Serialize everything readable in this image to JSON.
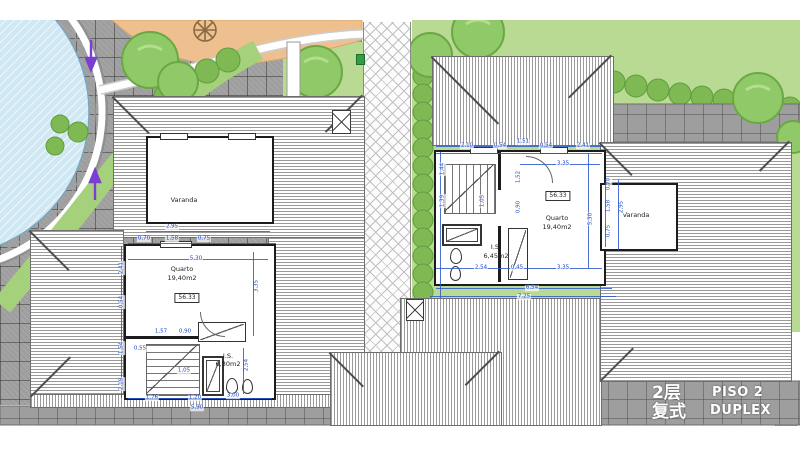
{
  "footer": {
    "floor_cn": "2层",
    "type_cn": "复式",
    "floor_pt": "PISO 2",
    "type_pt": "DUPLEX"
  },
  "colors": {
    "dimension_blue": "#1746c8",
    "wall_black": "#1c1c1c",
    "paving_gray": "#9e9e9e",
    "lawn_green": "#b8da92",
    "hedge_green": "#7fb954",
    "tree_green": "#90c967",
    "pool_blue": "#cfe8f4",
    "sand_orange": "#eec08f",
    "arrow_purple": "#7a3fd1",
    "footer_text": "#ffffff"
  },
  "units": {
    "left": {
      "area_code": "56.33",
      "area_box": {
        "x": 187,
        "y": 298
      },
      "room_labels": [
        {
          "t": "Varanda",
          "x": 184,
          "y": 200
        },
        {
          "t": "Quarto",
          "x": 182,
          "y": 269
        },
        {
          "t": "19,40m2",
          "x": 182,
          "y": 278
        },
        {
          "t": "I.S.",
          "x": 228,
          "y": 356
        },
        {
          "t": "6,30m2",
          "x": 228,
          "y": 364
        }
      ],
      "dims": [
        {
          "t": "2,95",
          "x": 172,
          "y": 227
        },
        {
          "t": "0,70",
          "x": 144,
          "y": 239
        },
        {
          "t": "1,58",
          "x": 172,
          "y": 239
        },
        {
          "t": "0,75",
          "x": 204,
          "y": 239
        },
        {
          "t": "5,30",
          "x": 196,
          "y": 259
        },
        {
          "t": "3,35",
          "x": 257,
          "y": 286,
          "v": true
        },
        {
          "t": "2,41",
          "x": 122,
          "y": 268,
          "v": true
        },
        {
          "t": "0,54",
          "x": 122,
          "y": 302,
          "v": true
        },
        {
          "t": "1,54",
          "x": 122,
          "y": 348,
          "v": true
        },
        {
          "t": "2,19",
          "x": 122,
          "y": 384,
          "v": true
        },
        {
          "t": "1,57",
          "x": 161,
          "y": 332
        },
        {
          "t": "0,90",
          "x": 185,
          "y": 332
        },
        {
          "t": "0,55",
          "x": 140,
          "y": 349
        },
        {
          "t": "1,05",
          "x": 184,
          "y": 371
        },
        {
          "t": "2,54",
          "x": 247,
          "y": 365,
          "v": true
        },
        {
          "t": "1,76",
          "x": 152,
          "y": 398
        },
        {
          "t": "1,20",
          "x": 195,
          "y": 398
        },
        {
          "t": "3,00",
          "x": 233,
          "y": 396
        },
        {
          "t": "5,90",
          "x": 197,
          "y": 408
        }
      ],
      "dimlines": [
        {
          "x": 146,
          "y": 231,
          "w": 124,
          "h": 1
        },
        {
          "x": 128,
          "y": 243,
          "w": 148,
          "h": 1
        },
        {
          "x": 128,
          "y": 259,
          "w": 140,
          "h": 1
        },
        {
          "x": 121,
          "y": 246,
          "w": 1,
          "h": 152
        },
        {
          "x": 253,
          "y": 252,
          "w": 1,
          "h": 84
        },
        {
          "x": 243,
          "y": 348,
          "w": 1,
          "h": 46
        },
        {
          "x": 128,
          "y": 398,
          "w": 144,
          "h": 1
        },
        {
          "x": 124,
          "y": 407,
          "w": 150,
          "h": 1
        }
      ]
    },
    "right": {
      "area_code": "56.33",
      "area_box": {
        "x": 558,
        "y": 196
      },
      "room_labels": [
        {
          "t": "Quarto",
          "x": 557,
          "y": 218
        },
        {
          "t": "19,40m2",
          "x": 557,
          "y": 227
        },
        {
          "t": "I.S.",
          "x": 496,
          "y": 247
        },
        {
          "t": "6,45m2",
          "x": 496,
          "y": 256
        },
        {
          "t": "Varanda",
          "x": 636,
          "y": 215
        }
      ],
      "dims": [
        {
          "t": "2,10",
          "x": 467,
          "y": 146
        },
        {
          "t": "0,54",
          "x": 500,
          "y": 146
        },
        {
          "t": "1,51",
          "x": 523,
          "y": 142
        },
        {
          "t": "0,54",
          "x": 546,
          "y": 146
        },
        {
          "t": "2,41",
          "x": 583,
          "y": 146
        },
        {
          "t": "3,35",
          "x": 563,
          "y": 164
        },
        {
          "t": "1,52",
          "x": 519,
          "y": 177,
          "v": true
        },
        {
          "t": "0,90",
          "x": 519,
          "y": 207,
          "v": true
        },
        {
          "t": "1,05",
          "x": 483,
          "y": 201,
          "v": true
        },
        {
          "t": "1,44",
          "x": 443,
          "y": 169,
          "v": true
        },
        {
          "t": "1,39",
          "x": 443,
          "y": 201,
          "v": true
        },
        {
          "t": "5,30",
          "x": 591,
          "y": 219,
          "v": true
        },
        {
          "t": "2,54",
          "x": 481,
          "y": 268
        },
        {
          "t": "0,45",
          "x": 517,
          "y": 268
        },
        {
          "t": "3,35",
          "x": 563,
          "y": 268
        },
        {
          "t": "6,54",
          "x": 532,
          "y": 288
        },
        {
          "t": "7,25",
          "x": 524,
          "y": 297
        },
        {
          "t": "0,70",
          "x": 609,
          "y": 184,
          "v": true
        },
        {
          "t": "1,58",
          "x": 609,
          "y": 206,
          "v": true
        },
        {
          "t": "2,95",
          "x": 622,
          "y": 207,
          "v": true
        },
        {
          "t": "0,75",
          "x": 609,
          "y": 231,
          "v": true
        }
      ],
      "dimlines": [
        {
          "x": 436,
          "y": 146,
          "w": 166,
          "h": 1
        },
        {
          "x": 436,
          "y": 153,
          "w": 166,
          "h": 1
        },
        {
          "x": 520,
          "y": 164,
          "w": 80,
          "h": 1
        },
        {
          "x": 440,
          "y": 152,
          "w": 1,
          "h": 146
        },
        {
          "x": 588,
          "y": 154,
          "w": 1,
          "h": 114
        },
        {
          "x": 436,
          "y": 268,
          "w": 166,
          "h": 1
        },
        {
          "x": 436,
          "y": 288,
          "w": 176,
          "h": 1
        },
        {
          "x": 430,
          "y": 296,
          "w": 186,
          "h": 1
        },
        {
          "x": 605,
          "y": 183,
          "w": 1,
          "h": 64
        },
        {
          "x": 618,
          "y": 180,
          "w": 1,
          "h": 70
        }
      ]
    }
  }
}
